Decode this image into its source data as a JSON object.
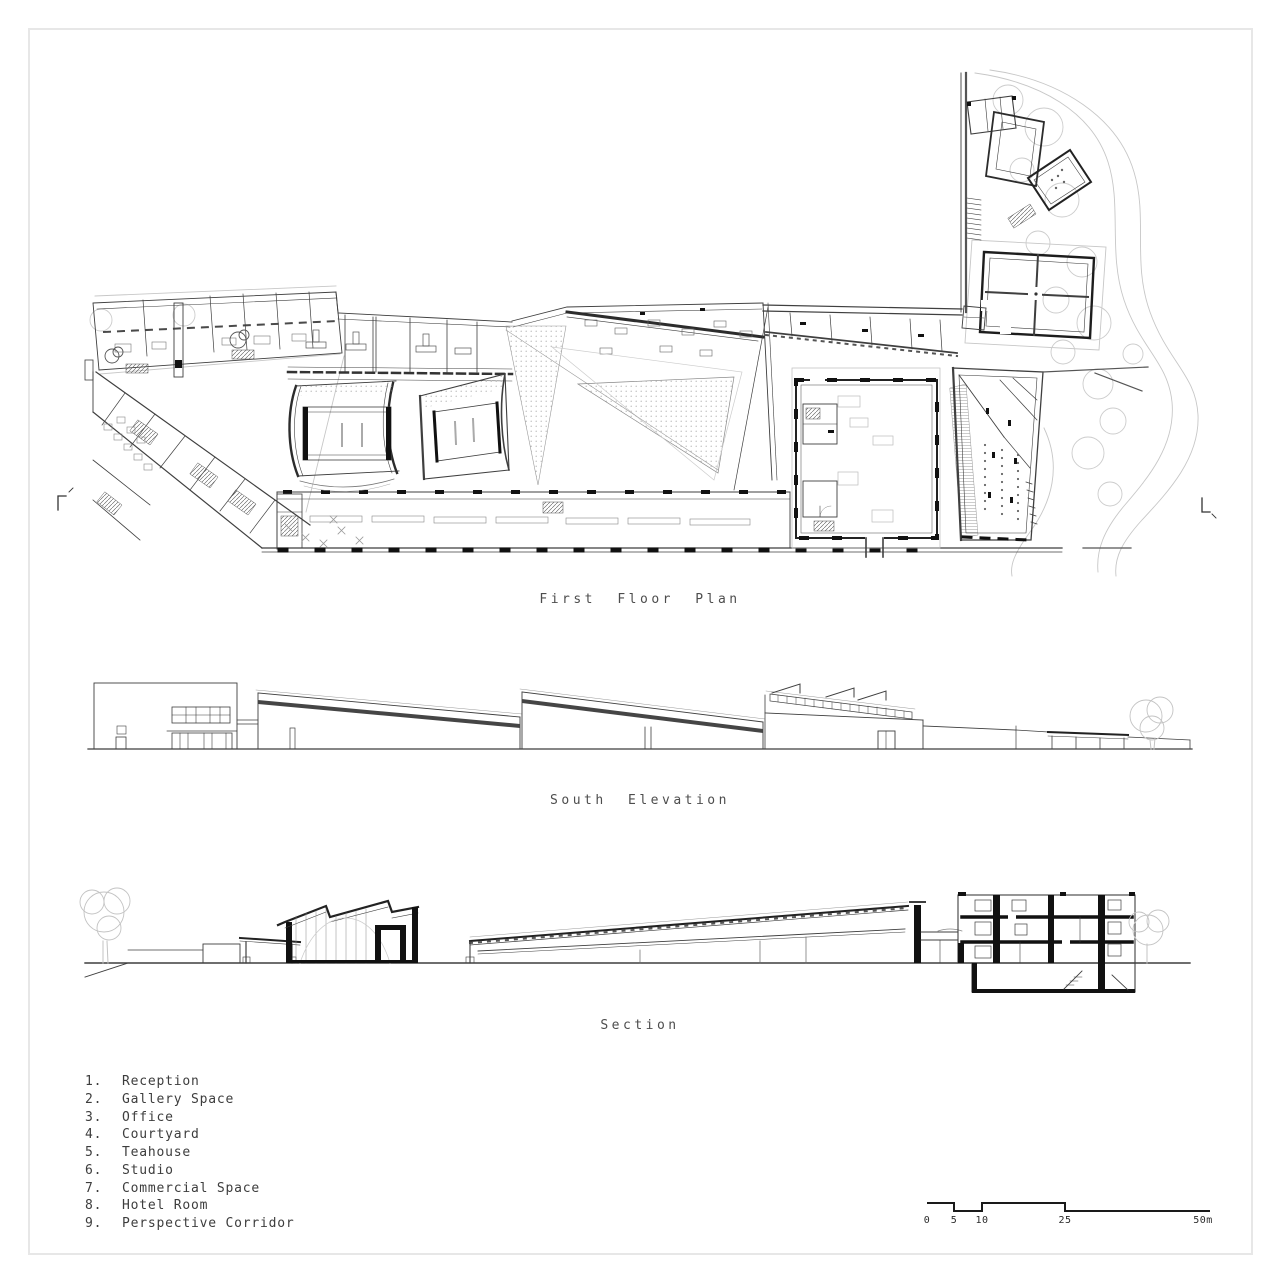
{
  "sheet": {
    "background": "#ffffff",
    "border_color": "#e7e7e7"
  },
  "titles": {
    "floor_plan": "First Floor Plan",
    "south_elevation": "South Elevation",
    "section": "Section"
  },
  "legend": {
    "items": [
      {
        "number": "1.",
        "name": "Reception"
      },
      {
        "number": "2.",
        "name": "Gallery Space"
      },
      {
        "number": "3.",
        "name": "Office"
      },
      {
        "number": "4.",
        "name": "Courtyard"
      },
      {
        "number": "5.",
        "name": "Teahouse"
      },
      {
        "number": "6.",
        "name": "Studio"
      },
      {
        "number": "7.",
        "name": "Commercial Space"
      },
      {
        "number": "8.",
        "name": "Hotel Room"
      },
      {
        "number": "9.",
        "name": "Perspective Corridor"
      }
    ]
  },
  "scale_bar": {
    "labels": [
      "0",
      "5",
      "10",
      "25",
      "50m"
    ]
  },
  "colors": {
    "line": "#3f3f3f",
    "poche": "#111111",
    "landscape_gray": "#c7c7c7",
    "text": "#4a4a4a"
  }
}
